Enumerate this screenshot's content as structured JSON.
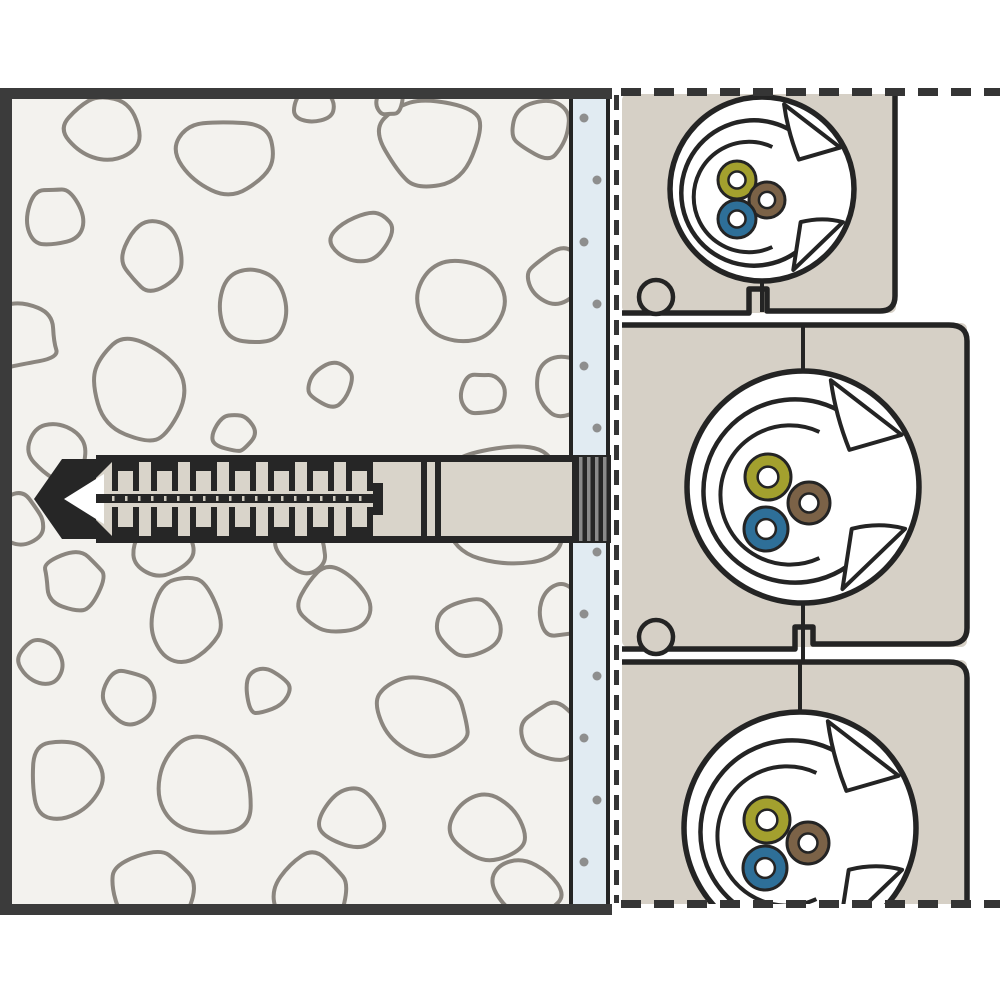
{
  "diagram": {
    "title": "wall-anchor-with-flush-mount-socket-boxes-cross-section",
    "colors": {
      "white": "#ffffff",
      "wall_fill": "#f3f2ee",
      "stone_line": "#8b867f",
      "border": "#3b3b3b",
      "plaster_fill": "#e1ebf2",
      "plaster_dot": "#8e8e8e",
      "dash": "#353535",
      "box_fill": "#d6d0c6",
      "ink": "#242424",
      "anchor_fill": "#d9d4ca",
      "anchor_dark": "#262626",
      "collar_stripe": "#8a8a8a",
      "tick": "#cfcabf",
      "wire_green_yellow": "#a3a02e",
      "wire_brown": "#7b6247",
      "wire_blue": "#2e6f98"
    },
    "wall": {
      "x": 0,
      "y": 88,
      "w": 570,
      "h": 827,
      "border_w": 11,
      "border_right_x": 612
    },
    "plaster": {
      "x": 572,
      "y": 99,
      "w": 36,
      "h": 805,
      "dots": {
        "x_even": 584,
        "x_odd": 597,
        "y_start": 118,
        "step": 62,
        "count": 13,
        "skip_min": 448,
        "skip_max": 552,
        "r": 4.5
      }
    },
    "dashes": {
      "vertical": {
        "x": 616.5,
        "y1": 95,
        "y2": 903,
        "w": 5,
        "dash": "15 10"
      },
      "top": {
        "y": 92,
        "x1": 621,
        "x2": 1000,
        "w": 8,
        "dash": "20 13"
      },
      "bottom": {
        "y": 904,
        "x1": 621,
        "x2": 1000,
        "w": 8,
        "dash": "20 13"
      }
    },
    "stones": [
      [
        100,
        130,
        40,
        0.9,
        3
      ],
      [
        228,
        155,
        50,
        0.85,
        5
      ],
      [
        312,
        106,
        20,
        1,
        7
      ],
      [
        428,
        140,
        56,
        0.9,
        9
      ],
      [
        543,
        128,
        30,
        1,
        11
      ],
      [
        52,
        216,
        32,
        0.95,
        13
      ],
      [
        152,
        256,
        34,
        1.05,
        15
      ],
      [
        362,
        237,
        32,
        0.9,
        17
      ],
      [
        251,
        306,
        40,
        0.9,
        19
      ],
      [
        457,
        302,
        46,
        1.05,
        21
      ],
      [
        557,
        277,
        30,
        1,
        23
      ],
      [
        24,
        336,
        36,
        1,
        25
      ],
      [
        136,
        392,
        50,
        1.08,
        27
      ],
      [
        331,
        383,
        24,
        1,
        29
      ],
      [
        483,
        393,
        22,
        1,
        31
      ],
      [
        564,
        386,
        32,
        1,
        33
      ],
      [
        233,
        433,
        22,
        1,
        35
      ],
      [
        58,
        453,
        30,
        1,
        37
      ],
      [
        505,
        505,
        74,
        1,
        39
      ],
      [
        163,
        548,
        32,
        1,
        41
      ],
      [
        300,
        547,
        27,
        1,
        43
      ],
      [
        72,
        582,
        32,
        1,
        45
      ],
      [
        186,
        617,
        42,
        1.05,
        47
      ],
      [
        332,
        602,
        37,
        0.95,
        49
      ],
      [
        471,
        627,
        32,
        1,
        51
      ],
      [
        562,
        612,
        27,
        1,
        53
      ],
      [
        40,
        661,
        24,
        1,
        55
      ],
      [
        131,
        696,
        28,
        1,
        57
      ],
      [
        266,
        691,
        24,
        1,
        59
      ],
      [
        421,
        712,
        50,
        0.92,
        61
      ],
      [
        552,
        732,
        32,
        1,
        63
      ],
      [
        66,
        777,
        42,
        1,
        65
      ],
      [
        206,
        788,
        54,
        1.02,
        67
      ],
      [
        352,
        817,
        34,
        1,
        69
      ],
      [
        491,
        832,
        40,
        0.95,
        71
      ],
      [
        151,
        888,
        44,
        1,
        73
      ],
      [
        312,
        892,
        40,
        1,
        75
      ],
      [
        527,
        890,
        34,
        1,
        77
      ],
      [
        18,
        520,
        26,
        1,
        79
      ],
      [
        390,
        100,
        16,
        1,
        81
      ]
    ],
    "anchor": {
      "band_top": 455,
      "band_bottom": 543,
      "outline_w": 7,
      "tip_pts": "34,499 62,459 96,459 96,539 62,539",
      "tip_triangle": "64,499 104,474 104,524",
      "body": {
        "x": 96,
        "x2": 362
      },
      "sleeve": {
        "x": 362,
        "x2": 572,
        "div1": 421,
        "div2": 435,
        "div_w": 6
      },
      "teeth": {
        "start": 112,
        "pitch": 39,
        "count": 7,
        "w": 27,
        "leg_w": 6,
        "bar_h": 9,
        "leg_h": 29
      },
      "axis": {
        "x": 96,
        "x2": 378,
        "y": 494,
        "h": 9,
        "tick_pitch": 13,
        "end_bar": {
          "x": 373,
          "y": 483,
          "w": 10,
          "h": 32
        }
      },
      "collar": {
        "x": 572,
        "w": 39,
        "y": 457,
        "h": 84,
        "stripes": [
          579,
          587,
          595,
          603
        ],
        "stripe_w": 3.5
      }
    },
    "boxes": [
      {
        "name": "top-box",
        "fill": {
          "x": 622,
          "y": 94,
          "w": 274,
          "h": 219
        },
        "stroke_path": "M895,94 V296 Q895,311 880,311 H767 V289 H749 V313 H622",
        "split": [
          [
            762,
            92,
            762,
            100
          ],
          [
            762,
            280,
            762,
            312
          ]
        ],
        "circle": {
          "cx": 762,
          "cy": 189,
          "r": 92
        },
        "wires": [
          {
            "color": "wire_green_yellow",
            "name": "earth-wire",
            "cx": 737,
            "cy": 180,
            "r": 19
          },
          {
            "color": "wire_brown",
            "name": "live-wire",
            "cx": 767,
            "cy": 200,
            "r": 18
          },
          {
            "color": "wire_blue",
            "name": "neutral-wire",
            "cx": 737,
            "cy": 219,
            "r": 19
          }
        ],
        "knockout": {
          "cx": 656,
          "cy": 297,
          "r": 17
        }
      },
      {
        "name": "middle-box",
        "fill": {
          "x": 622,
          "y": 323,
          "w": 345,
          "h": 324
        },
        "stroke_path": "M622,325 H949 Q967,325 967,341 V628 Q967,644 949,644 H813 V627 H795 V649 H622",
        "split": [
          [
            803,
            325,
            803,
            373
          ],
          [
            803,
            601,
            803,
            660
          ]
        ],
        "circle": {
          "cx": 803,
          "cy": 487,
          "r": 116
        },
        "wires": [
          {
            "color": "wire_green_yellow",
            "name": "earth-wire",
            "cx": 768,
            "cy": 477,
            "r": 23
          },
          {
            "color": "wire_brown",
            "name": "live-wire",
            "cx": 809,
            "cy": 503,
            "r": 21
          },
          {
            "color": "wire_blue",
            "name": "neutral-wire",
            "cx": 766,
            "cy": 529,
            "r": 22
          }
        ],
        "knockout": {
          "cx": 656,
          "cy": 637,
          "r": 17
        }
      },
      {
        "name": "bottom-box",
        "fill": {
          "x": 622,
          "y": 660,
          "w": 345,
          "h": 246
        },
        "stroke_path": "M622,662 H949 Q967,662 967,678 V906",
        "split": [
          [
            800,
            662,
            800,
            714
          ]
        ],
        "circle": {
          "cx": 800,
          "cy": 828,
          "r": 116
        },
        "wires": [
          {
            "color": "wire_green_yellow",
            "name": "earth-wire",
            "cx": 767,
            "cy": 820,
            "r": 23
          },
          {
            "color": "wire_brown",
            "name": "live-wire",
            "cx": 808,
            "cy": 843,
            "r": 21
          },
          {
            "color": "wire_blue",
            "name": "neutral-wire",
            "cx": 765,
            "cy": 868,
            "r": 22
          }
        ],
        "knockout": null
      }
    ]
  }
}
